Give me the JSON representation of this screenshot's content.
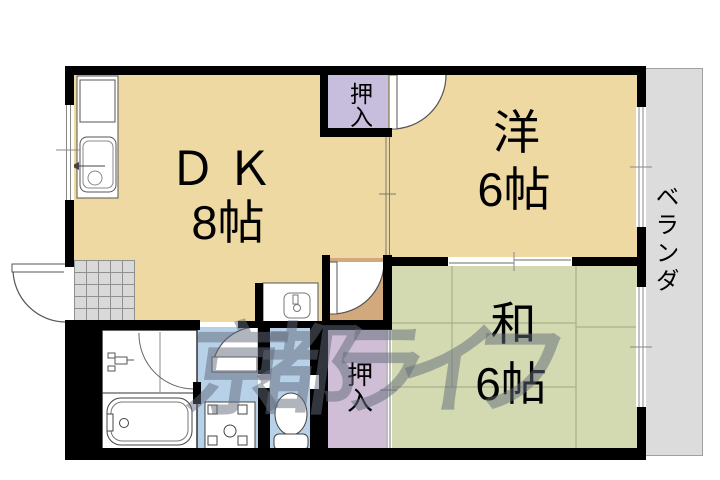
{
  "floorplan": {
    "watermark": "京都ライフ",
    "rooms": {
      "dk": {
        "name": "ＤＫ",
        "size": "8帖"
      },
      "western": {
        "name": "洋",
        "size": "6帖"
      },
      "japanese": {
        "name": "和",
        "size": "6帖"
      }
    },
    "closets": {
      "top": "押入",
      "bottom": "押入"
    },
    "balcony": "ベランダ",
    "colors": {
      "floor_wood": "#eed9a2",
      "floor_tatami": "#d3d9b0",
      "closet_top": "#c7bddd",
      "closet_bottom": "#cfbed6",
      "wet_area": "#b6d1e8",
      "hall": "#d2a97c",
      "balcony": "#dcdcdc",
      "entry_tile": "#d9d9d9",
      "wall": "#000000",
      "watermark": "rgba(97,106,122,0.5)"
    }
  }
}
